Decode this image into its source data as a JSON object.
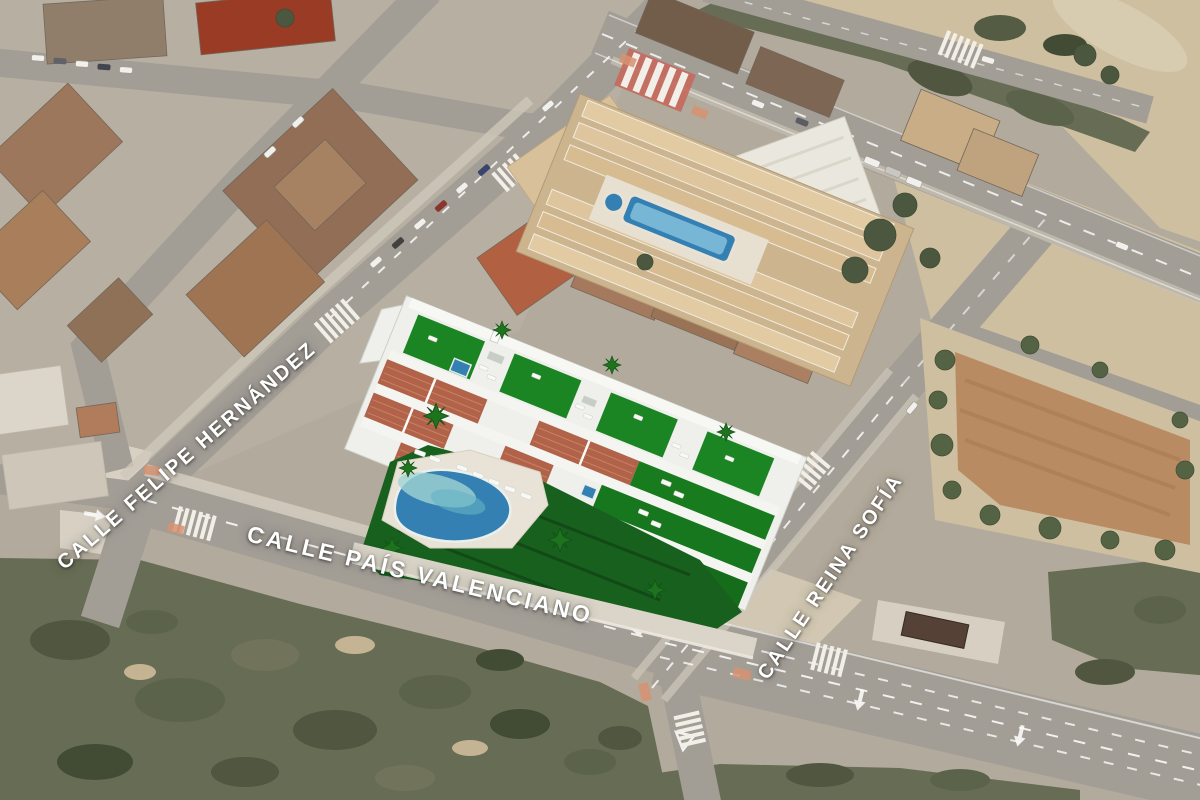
{
  "street_labels": {
    "felipe_hernandez": "CALLE FELIPE HERNÁNDEZ",
    "pais_valenciano": "CALLE PAÍS VALENCIANO",
    "reina_sofia": "CALLE REINA SOFÍA"
  },
  "colors": {
    "turf": "#12821d",
    "pool": "#2e7eb4",
    "pool_light": "#9fd6d4",
    "terracotta": "#b05f45",
    "road": "#a19d96",
    "scrub": "#626951",
    "sand": "#cfc0a2",
    "building_white": "#f2f4f1",
    "label_text": "#ffffff"
  }
}
